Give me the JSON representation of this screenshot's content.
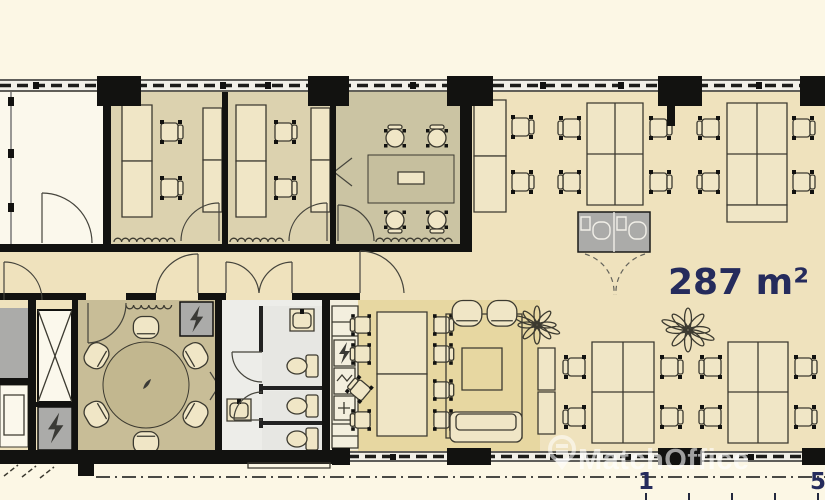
{
  "labels": {
    "area": "287 m²",
    "watermark": "MatchOffice",
    "scale_start": "1",
    "scale_end": "5"
  },
  "icons": {
    "watermark_logo": "location-pin-icon",
    "electrical_shaft": "lightning-icon",
    "greenery": "plant-icon"
  },
  "colors": {
    "background": "#FCF7E5",
    "open_floor": "#EFE2BD",
    "office_floor": "#DCD2AF",
    "meeting_floor": "#CBC4A3",
    "dining_floor": "#C8BD97",
    "lounge_floor": "#E7D7A1",
    "bathroom_floor": "#EDEDE9",
    "white_room": "#FBF8EC",
    "kitchen_strip": "#F3EFDE",
    "shaft_gray": "#ABABA9",
    "desk_fill": "#F0E6C6",
    "wall": "#121210",
    "line": "#3c3a30",
    "area_text": "#252B5C",
    "watermark_text": "rgba(255,255,255,0.6)"
  }
}
